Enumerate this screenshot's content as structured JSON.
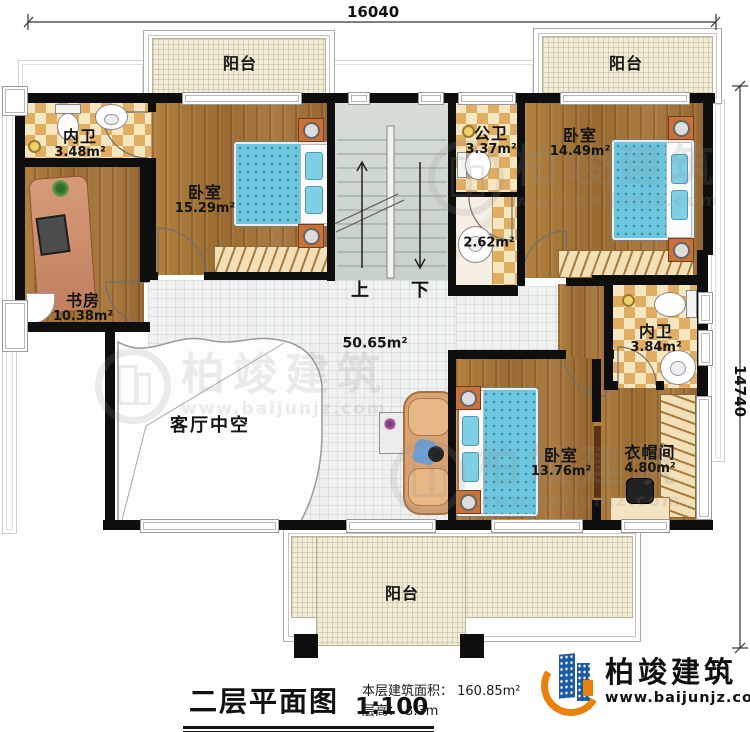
{
  "dimensions": {
    "top": "16040",
    "right": "14740"
  },
  "rooms": {
    "balcony_top_left": {
      "name": "阳台"
    },
    "balcony_top_right": {
      "name": "阳台"
    },
    "balcony_bottom": {
      "name": "阳台"
    },
    "bath_ensuite_left": {
      "name": "内卫",
      "area": "3.48m²"
    },
    "bedroom_top_left": {
      "name": "卧室",
      "area": "15.29m²"
    },
    "study": {
      "name": "书房",
      "area": "10.38m²"
    },
    "bath_public": {
      "name": "公卫",
      "area": "3.37m²"
    },
    "wash_area": {
      "area": "2.62m²"
    },
    "bedroom_top_right": {
      "name": "卧室",
      "area": "14.49m²"
    },
    "bath_ensuite_right": {
      "name": "内卫",
      "area": "3.84m²"
    },
    "bedroom_bottom": {
      "name": "卧室",
      "area": "13.76m²"
    },
    "cloakroom": {
      "name": "衣帽间",
      "area": "4.80m²"
    },
    "hall": {
      "area": "50.65m²"
    },
    "void": {
      "name": "客厅中空"
    }
  },
  "stairs": {
    "up": "上",
    "down": "下"
  },
  "legend": {
    "title": "二层平面图",
    "scale": "1:100",
    "area_line": "本层建筑面积： 160.85m²",
    "height_line": "层高： 3.3m"
  },
  "brand": {
    "name": "柏竣建筑",
    "url": "www.baijunjz.com",
    "blue": "#1c5ca4",
    "orange": "#e8820c"
  },
  "watermark": {
    "name": "柏竣建筑",
    "url": "www.baijunjz.com"
  }
}
